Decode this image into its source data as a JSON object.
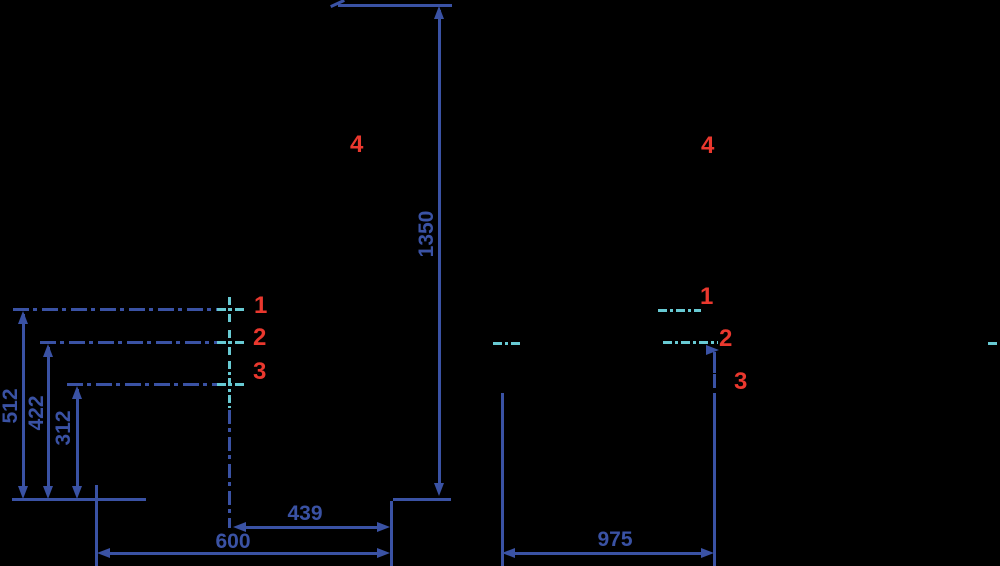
{
  "colors": {
    "background": "#000000",
    "blue": "#3A52A4",
    "cyan": "#68CAD3",
    "red": "#EA382E"
  },
  "left_view": {
    "dimensions": {
      "height_total": "1350",
      "height_point1": "512",
      "height_point2": "422",
      "height_point3": "312",
      "width_inner": "439",
      "width_total": "600"
    },
    "point_labels": {
      "p1": "1",
      "p2": "2",
      "p3": "3",
      "p4": "4"
    }
  },
  "right_view": {
    "dimensions": {
      "width_total": "975"
    },
    "point_labels": {
      "p1": "1",
      "p2": "2",
      "p3": "3",
      "p4": "4"
    }
  }
}
